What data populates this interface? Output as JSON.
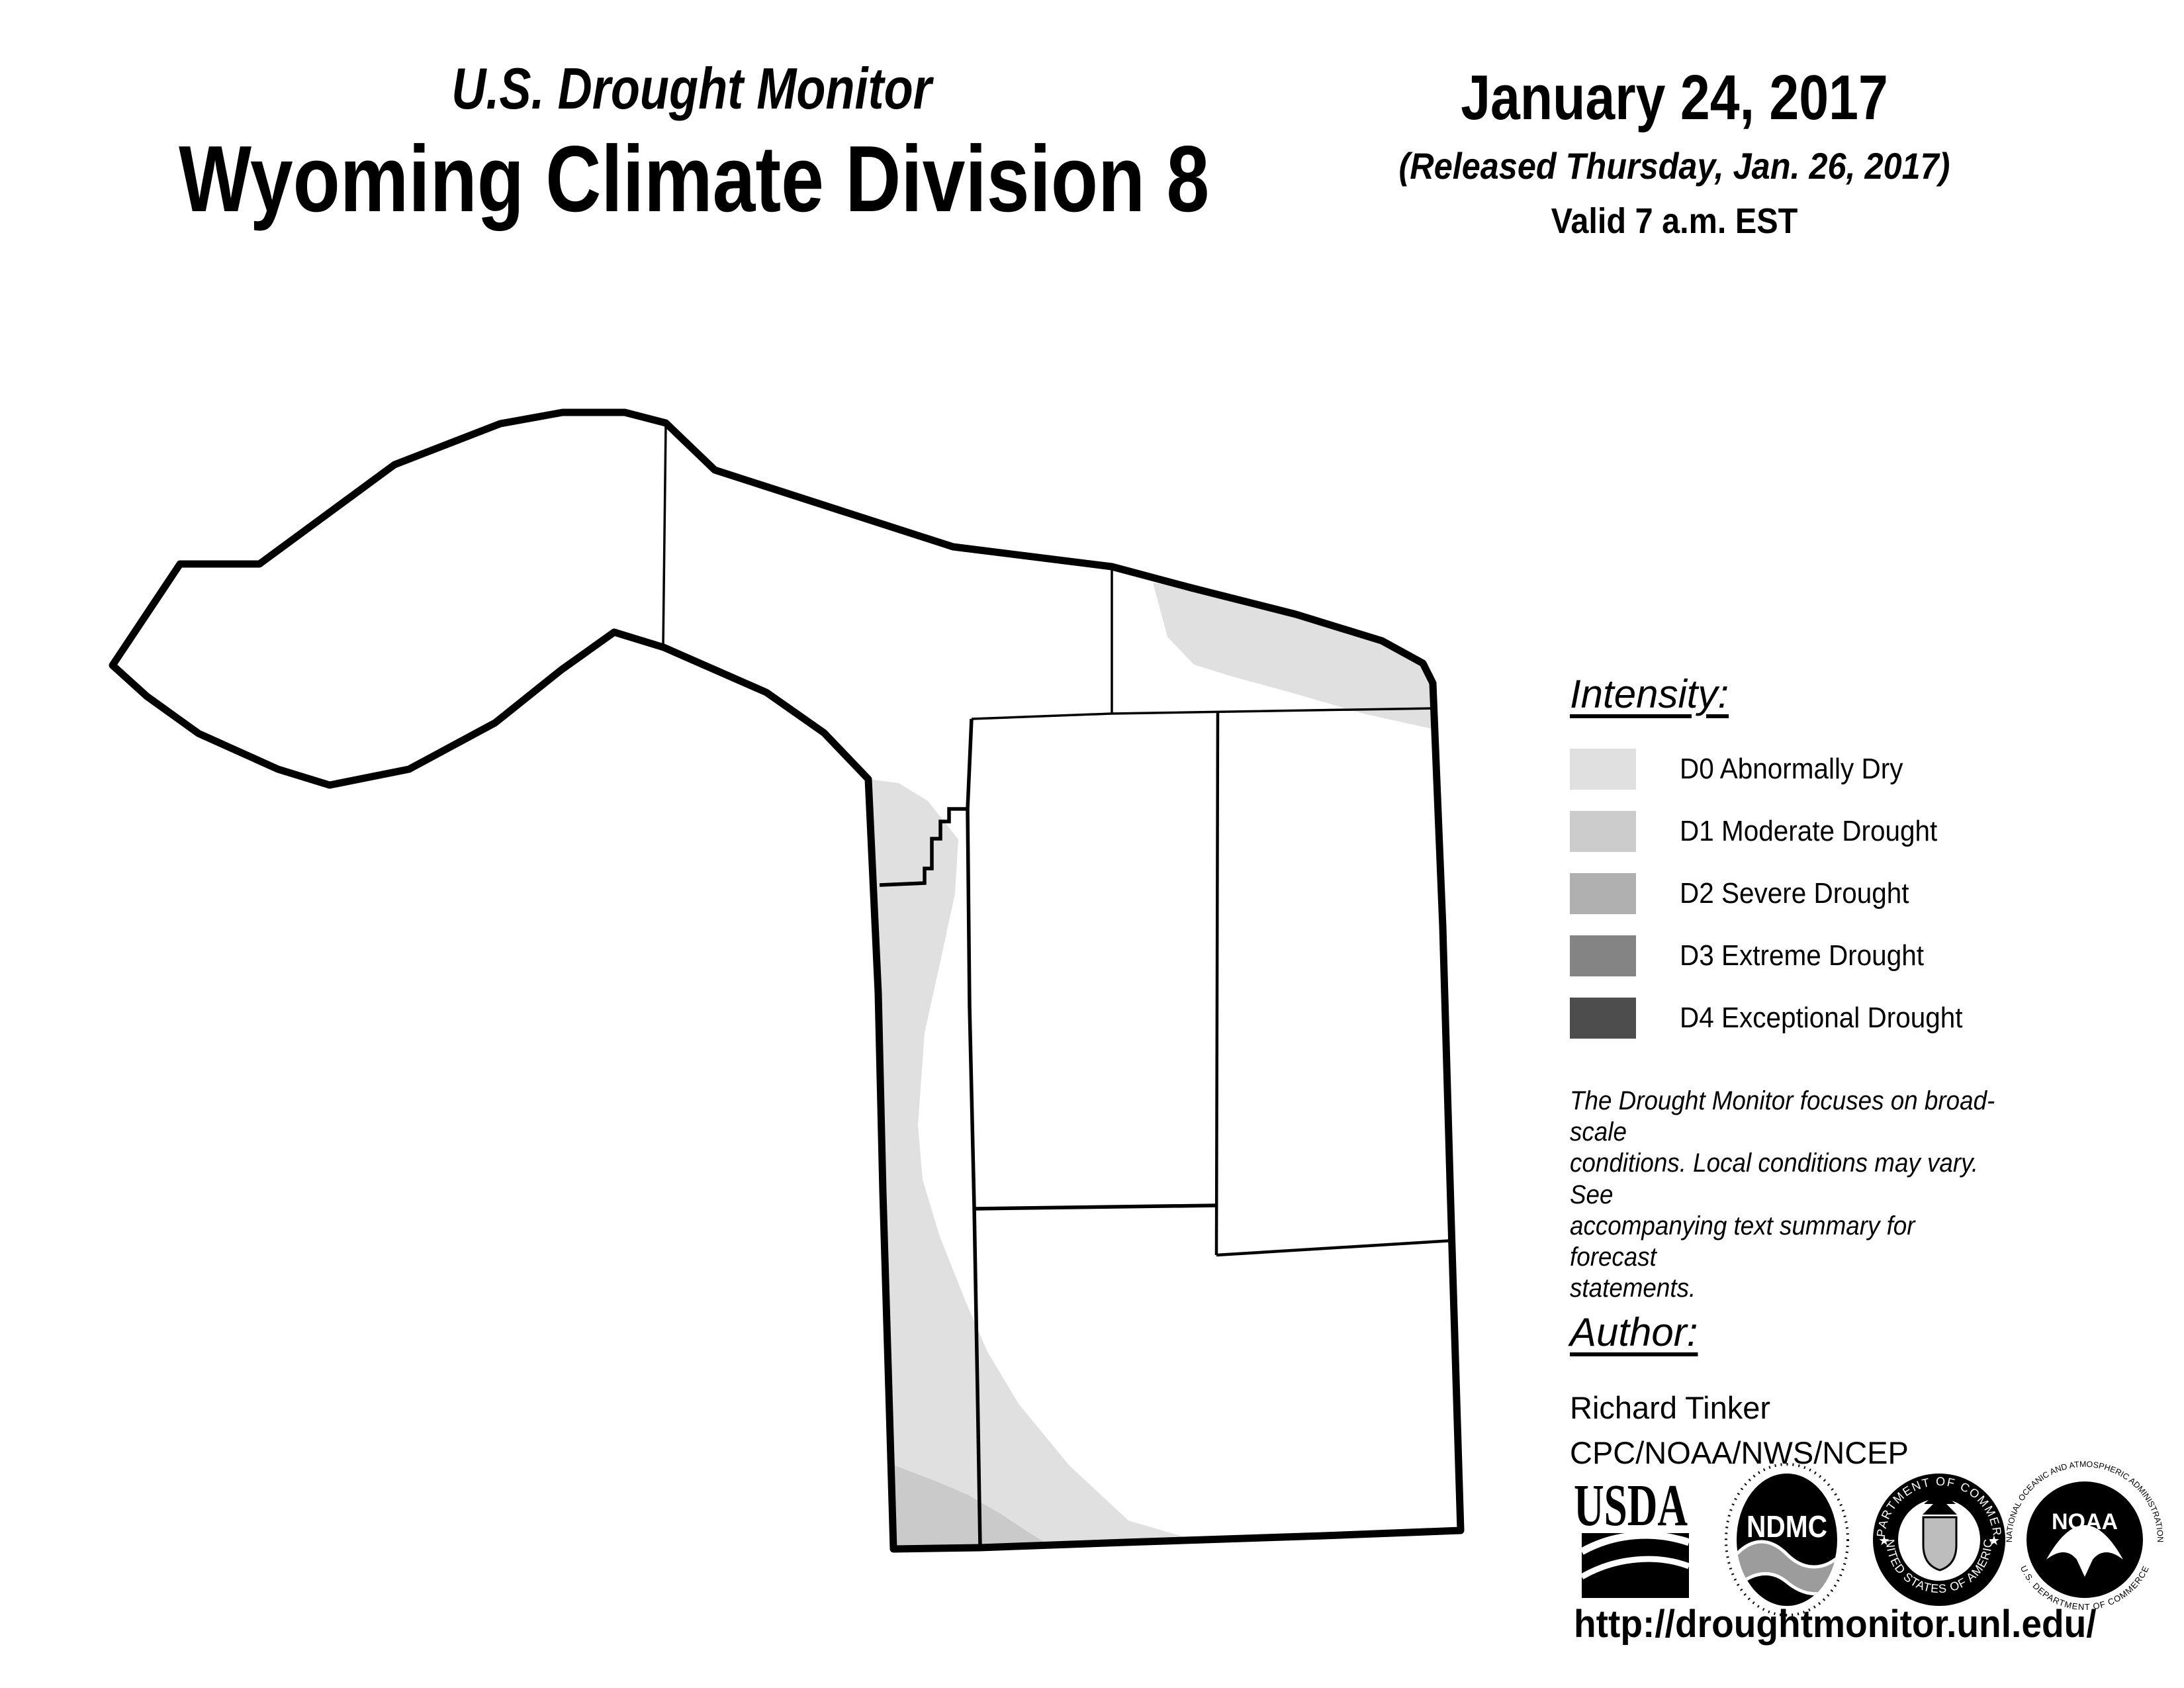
{
  "header": {
    "title_line1": "U.S. Drought Monitor",
    "title_line2": "Wyoming Climate Division 8",
    "date": "January 24, 2017",
    "released": "(Released Thursday, Jan. 26, 2017)",
    "valid": "Valid 7 a.m. EST"
  },
  "legend": {
    "heading": "Intensity:",
    "items": [
      {
        "code": "D0",
        "label": "D0 Abnormally Dry",
        "color": "#e0e0e0"
      },
      {
        "code": "D1",
        "label": "D1 Moderate Drought",
        "color": "#cccccc"
      },
      {
        "code": "D2",
        "label": "D2 Severe Drought",
        "color": "#b0b0b0"
      },
      {
        "code": "D3",
        "label": "D3 Extreme Drought",
        "color": "#848484"
      },
      {
        "code": "D4",
        "label": "D4 Exceptional Drought",
        "color": "#4d4d4d"
      }
    ]
  },
  "disclaimer": "The Drought Monitor focuses on broad-scale\nconditions. Local conditions may vary. See\naccompanying text summary for forecast\nstatements.",
  "author": {
    "heading": "Author:",
    "name": "Richard Tinker",
    "org": "CPC/NOAA/NWS/NCEP"
  },
  "footer": {
    "url": "http://droughtmonitor.unl.edu/"
  },
  "logos": {
    "usda": {
      "label": "USDA"
    },
    "ndmc": {
      "label": "NDMC"
    },
    "doc": {
      "ring_top": "DEPARTMENT OF COMMERCE",
      "ring_bottom": "UNITED STATES OF AMERICA",
      "star": "★"
    },
    "noaa": {
      "label": "NOAA",
      "ring_top": "NATIONAL OCEANIC AND ATMOSPHERIC ADMINISTRATION",
      "ring_bottom": "U.S. DEPARTMENT OF COMMERCE"
    }
  },
  "map": {
    "region": "Wyoming Climate Division 8",
    "shaded_levels_present": [
      "D0",
      "D1"
    ],
    "drought_areas": [
      {
        "level": "D0",
        "location": "band along northeast division boundary"
      },
      {
        "level": "D0",
        "location": "band along west edge of southern block"
      },
      {
        "level": "D1",
        "location": "southwest corner of southern block"
      }
    ],
    "colors": {
      "outline": "#000000",
      "county_line": "#000000",
      "background": "#ffffff",
      "d0": "#e0e0e0",
      "d1": "#cacaca"
    }
  }
}
